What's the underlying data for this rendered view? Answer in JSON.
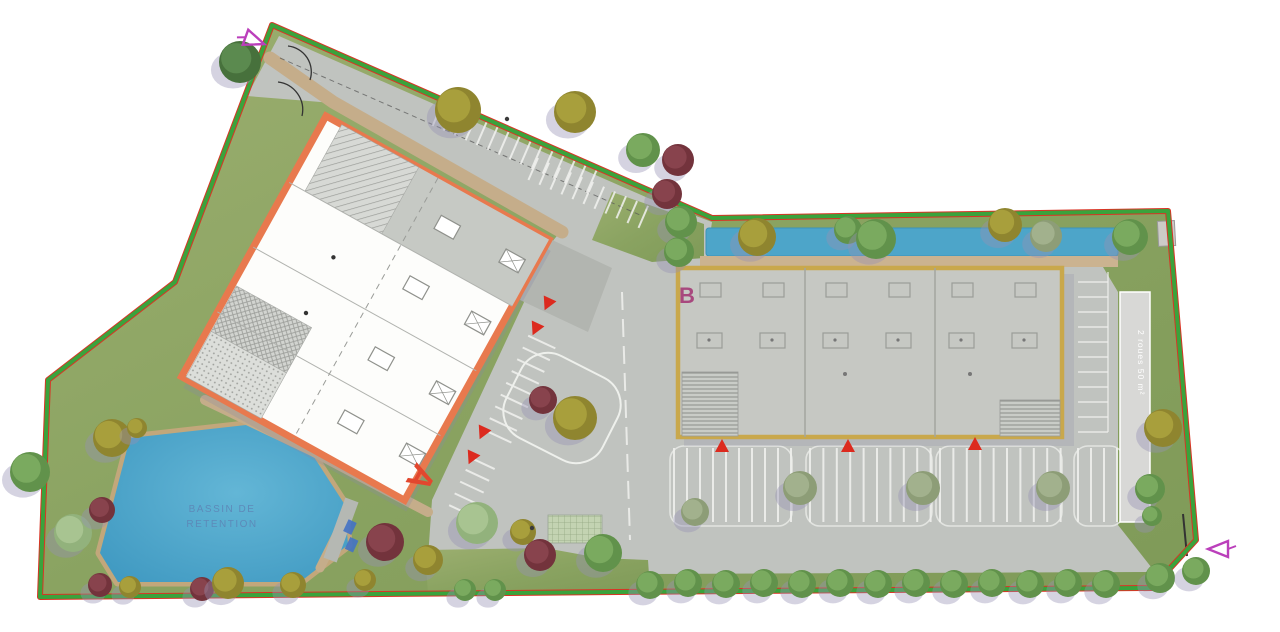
{
  "plan": {
    "building_a_label": "A",
    "building_b_label": "B",
    "basin_label_line1": "BASSIN DE",
    "basin_label_line2": "RETENTION",
    "bike_area_label": "2 roues 50 m²"
  },
  "colors": {
    "boundary_red": "#d93425",
    "hedge_green": "#3aa33c",
    "lawn_green": "#8da465",
    "pavement_gray": "#c0c3bf",
    "water_blue": "#4da5c9",
    "path_tan": "#c5ad8a",
    "building_a_fill": "#fdfdfb",
    "building_a_outline": "#e8794e",
    "building_b_fill": "#c6c8c3",
    "building_b_outline": "#c9a84c",
    "label_a_color": "#e2472e",
    "label_b_color": "#a8487e",
    "basin_text_color": "#5d84b5",
    "section_marker_color": "#bb3fbb",
    "entrance_marker_color": "#dc2a1e"
  },
  "tree_palette": {
    "green": {
      "base": "#61924b",
      "light": "#7fae63"
    },
    "darkgreen": {
      "base": "#47713c",
      "light": "#5f8e52"
    },
    "olive": {
      "base": "#8f852f",
      "light": "#ada33e"
    },
    "maroon": {
      "base": "#73333c",
      "light": "#8c4750"
    },
    "lightgreen": {
      "base": "#92b27c",
      "light": "#abc795"
    },
    "graygreen": {
      "base": "#8d9d77",
      "light": "#a6b590"
    }
  },
  "trees": [
    {
      "x": 240,
      "y": 62,
      "r": 21,
      "t": "darkgreen"
    },
    {
      "x": 458,
      "y": 110,
      "r": 23,
      "t": "olive"
    },
    {
      "x": 575,
      "y": 112,
      "r": 21,
      "t": "olive"
    },
    {
      "x": 643,
      "y": 150,
      "r": 17,
      "t": "green"
    },
    {
      "x": 678,
      "y": 160,
      "r": 16,
      "t": "maroon"
    },
    {
      "x": 667,
      "y": 194,
      "r": 15,
      "t": "maroon"
    },
    {
      "x": 681,
      "y": 222,
      "r": 16,
      "t": "green"
    },
    {
      "x": 679,
      "y": 252,
      "r": 15,
      "t": "green"
    },
    {
      "x": 757,
      "y": 237,
      "r": 19,
      "t": "olive"
    },
    {
      "x": 848,
      "y": 230,
      "r": 14,
      "t": "green"
    },
    {
      "x": 876,
      "y": 239,
      "r": 20,
      "t": "green"
    },
    {
      "x": 1005,
      "y": 225,
      "r": 17,
      "t": "olive"
    },
    {
      "x": 1046,
      "y": 236,
      "r": 16,
      "t": "graygreen"
    },
    {
      "x": 1130,
      "y": 237,
      "r": 18,
      "t": "green"
    },
    {
      "x": 1163,
      "y": 428,
      "r": 19,
      "t": "olive"
    },
    {
      "x": 1150,
      "y": 489,
      "r": 15,
      "t": "green"
    },
    {
      "x": 1152,
      "y": 516,
      "r": 10,
      "t": "green"
    },
    {
      "x": 695,
      "y": 512,
      "r": 14,
      "t": "graygreen"
    },
    {
      "x": 800,
      "y": 488,
      "r": 17,
      "t": "graygreen"
    },
    {
      "x": 923,
      "y": 488,
      "r": 17,
      "t": "graygreen"
    },
    {
      "x": 1053,
      "y": 488,
      "r": 17,
      "t": "graygreen"
    },
    {
      "x": 543,
      "y": 400,
      "r": 14,
      "t": "maroon"
    },
    {
      "x": 575,
      "y": 418,
      "r": 22,
      "t": "olive"
    },
    {
      "x": 30,
      "y": 472,
      "r": 20,
      "t": "green"
    },
    {
      "x": 73,
      "y": 533,
      "r": 19,
      "t": "lightgreen"
    },
    {
      "x": 102,
      "y": 510,
      "r": 13,
      "t": "maroon"
    },
    {
      "x": 112,
      "y": 438,
      "r": 19,
      "t": "olive"
    },
    {
      "x": 137,
      "y": 428,
      "r": 10,
      "t": "olive"
    },
    {
      "x": 100,
      "y": 585,
      "r": 12,
      "t": "maroon"
    },
    {
      "x": 130,
      "y": 587,
      "r": 11,
      "t": "olive"
    },
    {
      "x": 202,
      "y": 589,
      "r": 12,
      "t": "maroon"
    },
    {
      "x": 228,
      "y": 583,
      "r": 16,
      "t": "olive"
    },
    {
      "x": 293,
      "y": 585,
      "r": 13,
      "t": "olive"
    },
    {
      "x": 365,
      "y": 580,
      "r": 11,
      "t": "olive"
    },
    {
      "x": 385,
      "y": 542,
      "r": 19,
      "t": "maroon"
    },
    {
      "x": 428,
      "y": 560,
      "r": 15,
      "t": "olive"
    },
    {
      "x": 465,
      "y": 590,
      "r": 11,
      "t": "green"
    },
    {
      "x": 495,
      "y": 590,
      "r": 11,
      "t": "green"
    },
    {
      "x": 477,
      "y": 523,
      "r": 21,
      "t": "lightgreen"
    },
    {
      "x": 523,
      "y": 532,
      "r": 13,
      "t": "olive"
    },
    {
      "x": 540,
      "y": 555,
      "r": 16,
      "t": "maroon"
    },
    {
      "x": 603,
      "y": 553,
      "r": 19,
      "t": "green"
    },
    {
      "x": 650,
      "y": 585,
      "r": 14,
      "t": "green"
    },
    {
      "x": 688,
      "y": 583,
      "r": 14,
      "t": "green"
    },
    {
      "x": 726,
      "y": 584,
      "r": 14,
      "t": "green"
    },
    {
      "x": 764,
      "y": 583,
      "r": 14,
      "t": "green"
    },
    {
      "x": 802,
      "y": 584,
      "r": 14,
      "t": "green"
    },
    {
      "x": 840,
      "y": 583,
      "r": 14,
      "t": "green"
    },
    {
      "x": 878,
      "y": 584,
      "r": 14,
      "t": "green"
    },
    {
      "x": 916,
      "y": 583,
      "r": 14,
      "t": "green"
    },
    {
      "x": 954,
      "y": 584,
      "r": 14,
      "t": "green"
    },
    {
      "x": 992,
      "y": 583,
      "r": 14,
      "t": "green"
    },
    {
      "x": 1030,
      "y": 584,
      "r": 14,
      "t": "green"
    },
    {
      "x": 1068,
      "y": 583,
      "r": 14,
      "t": "green"
    },
    {
      "x": 1106,
      "y": 584,
      "r": 14,
      "t": "green"
    },
    {
      "x": 1160,
      "y": 578,
      "r": 15,
      "t": "green"
    },
    {
      "x": 1196,
      "y": 571,
      "r": 14,
      "t": "green"
    }
  ],
  "entrance_markers": [
    {
      "x": 548,
      "y": 303,
      "rot": 205
    },
    {
      "x": 536,
      "y": 328,
      "rot": 205
    },
    {
      "x": 483,
      "y": 432,
      "rot": 205
    },
    {
      "x": 472,
      "y": 457,
      "rot": 205
    },
    {
      "x": 722,
      "y": 447,
      "rot": 0
    },
    {
      "x": 848,
      "y": 447,
      "rot": 0
    },
    {
      "x": 975,
      "y": 445,
      "rot": 0
    }
  ],
  "section_markers": [
    {
      "x": 253,
      "y": 40,
      "rot": 20
    },
    {
      "x": 1220,
      "y": 549,
      "rot": 180
    }
  ],
  "lamps": [
    {
      "x": 507,
      "y": 119
    },
    {
      "x": 532,
      "y": 528
    }
  ]
}
